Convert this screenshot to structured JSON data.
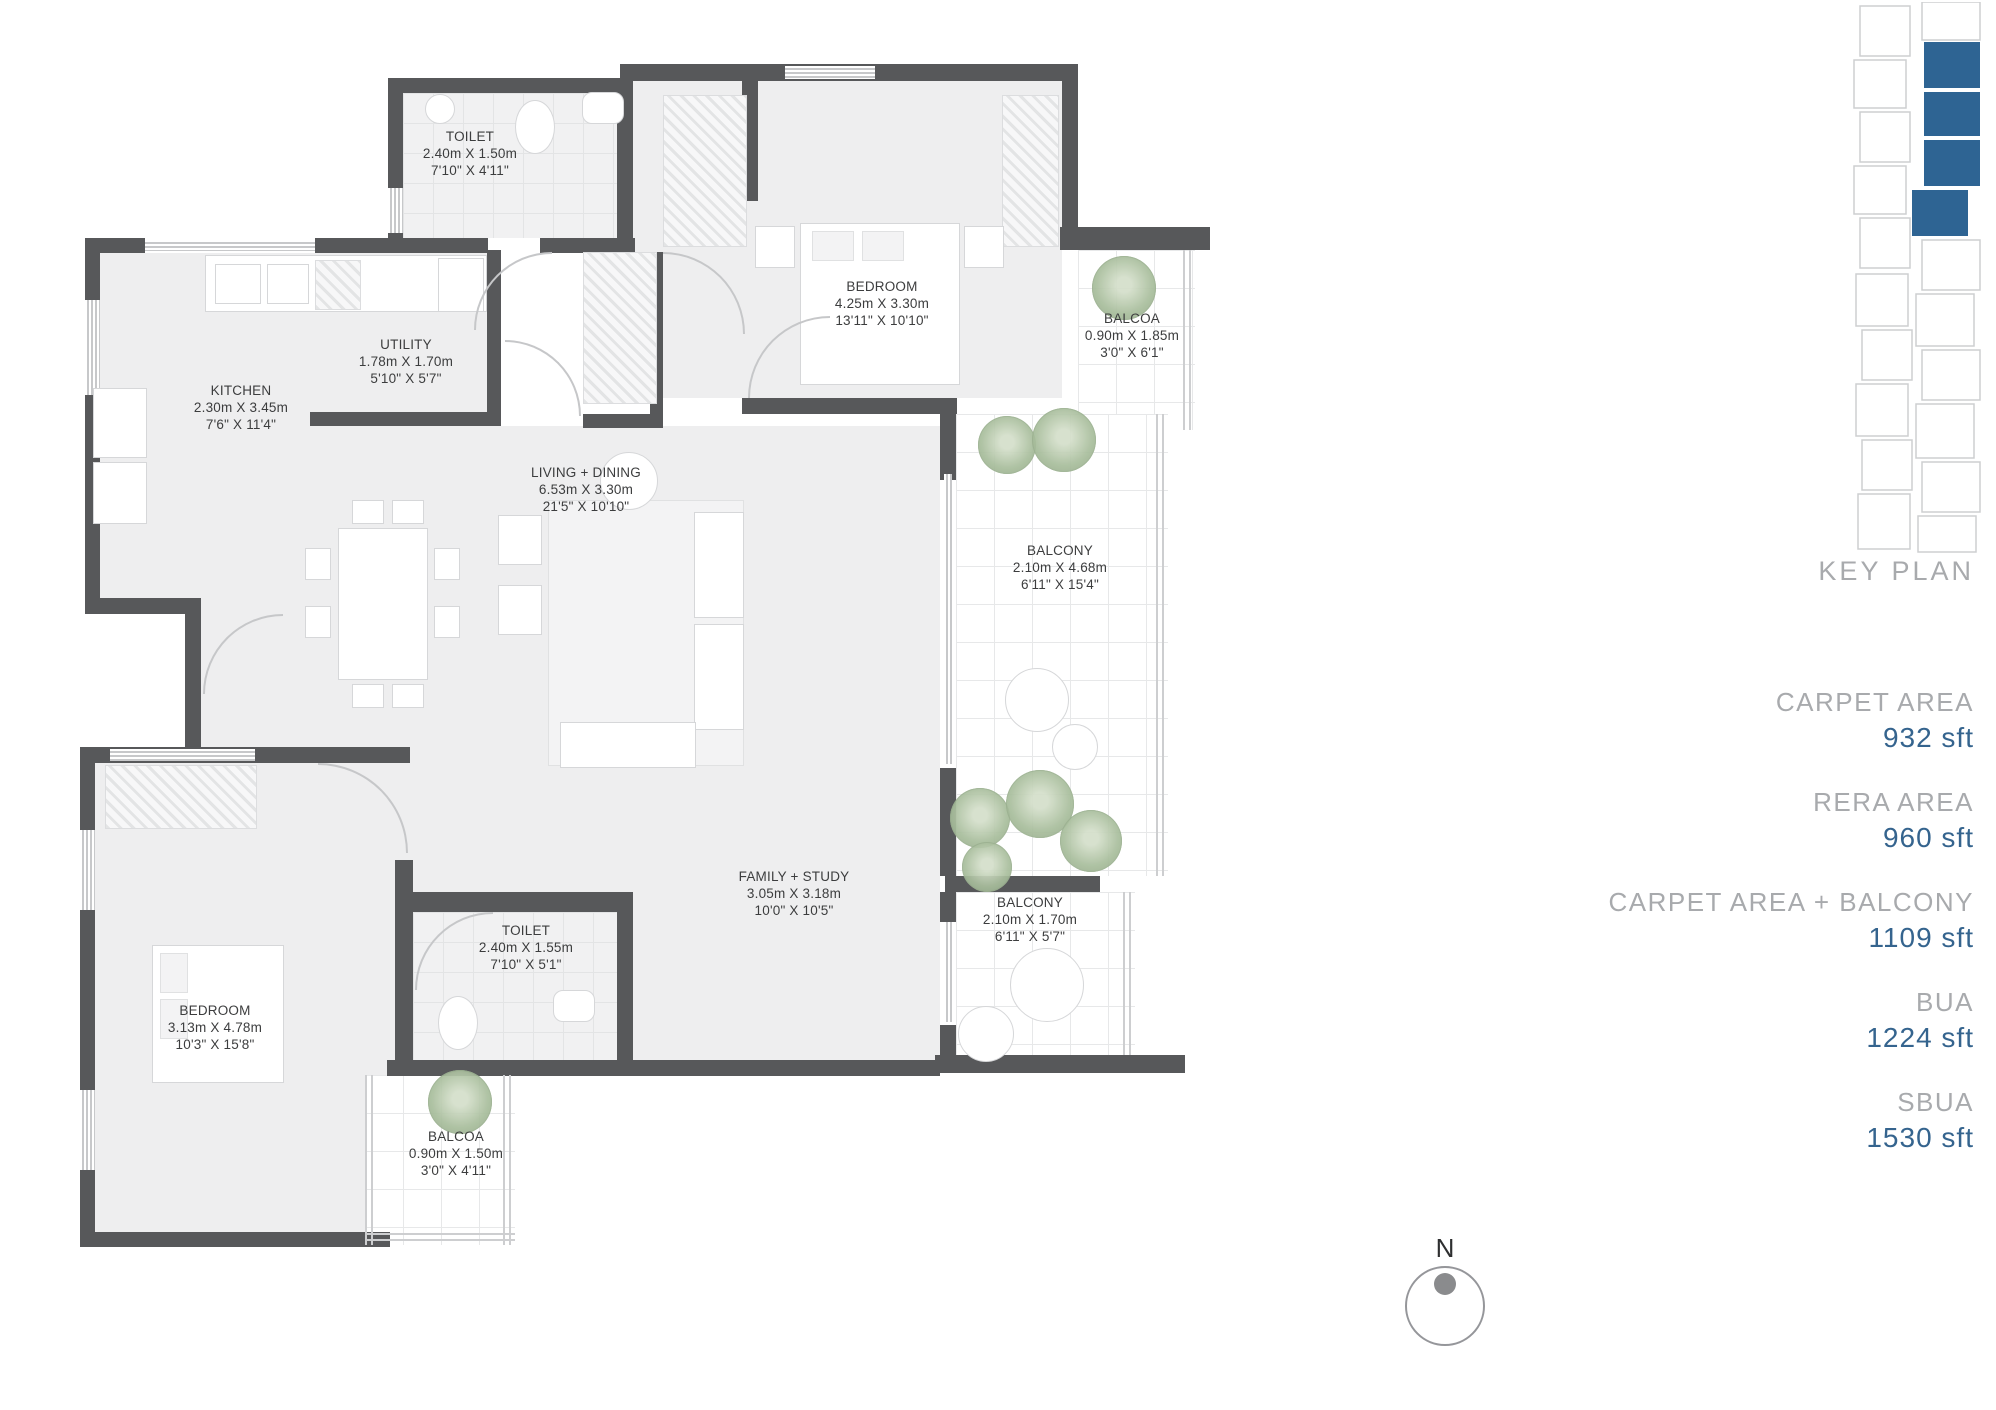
{
  "plan": {
    "rooms": [
      {
        "name": "TOILET",
        "metric": "2.40m X 1.50m",
        "imperial": "7'10\" X 4'11\""
      },
      {
        "name": "BEDROOM",
        "metric": "4.25m X 3.30m",
        "imperial": "13'11\" X 10'10\""
      },
      {
        "name": "BALCOA",
        "metric": "0.90m X 1.85m",
        "imperial": "3'0\" X 6'1\""
      },
      {
        "name": "KITCHEN",
        "metric": "2.30m X 3.45m",
        "imperial": "7'6\" X 11'4\""
      },
      {
        "name": "UTILITY",
        "metric": "1.78m X 1.70m",
        "imperial": "5'10\" X 5'7\""
      },
      {
        "name": "LIVING + DINING",
        "metric": "6.53m X 3.30m",
        "imperial": "21'5\" X 10'10\""
      },
      {
        "name": "BALCONY",
        "metric": "2.10m X 4.68m",
        "imperial": "6'11\" X 15'4\""
      },
      {
        "name": "FAMILY + STUDY",
        "metric": "3.05m X 3.18m",
        "imperial": "10'0\" X 10'5\""
      },
      {
        "name": "BALCONY",
        "metric": "2.10m X 1.70m",
        "imperial": "6'11\" X 5'7\""
      },
      {
        "name": "TOILET",
        "metric": "2.40m X 1.55m",
        "imperial": "7'10\" X 5'1\""
      },
      {
        "name": "BEDROOM",
        "metric": "3.13m X 4.78m",
        "imperial": "10'3\" X 15'8\""
      },
      {
        "name": "BALCOA",
        "metric": "0.90m X 1.50m",
        "imperial": "3'0\" X 4'11\""
      }
    ],
    "compass_label": "N"
  },
  "sidebar": {
    "key_plan_label": "KEY PLAN",
    "stats": [
      {
        "label": "CARPET AREA",
        "value": "932 sft"
      },
      {
        "label": "RERA AREA",
        "value": "960 sft"
      },
      {
        "label": "CARPET AREA + BALCONY",
        "value": "1109 sft"
      },
      {
        "label": "BUA",
        "value": "1224 sft"
      },
      {
        "label": "SBUA",
        "value": "1530 sft"
      }
    ]
  },
  "colors": {
    "wall": "#57585a",
    "highlight_blue": "#2e6493",
    "value_blue": "#35648e",
    "label_gray": "#a8aaad",
    "plant_green": "#aabf9e"
  }
}
